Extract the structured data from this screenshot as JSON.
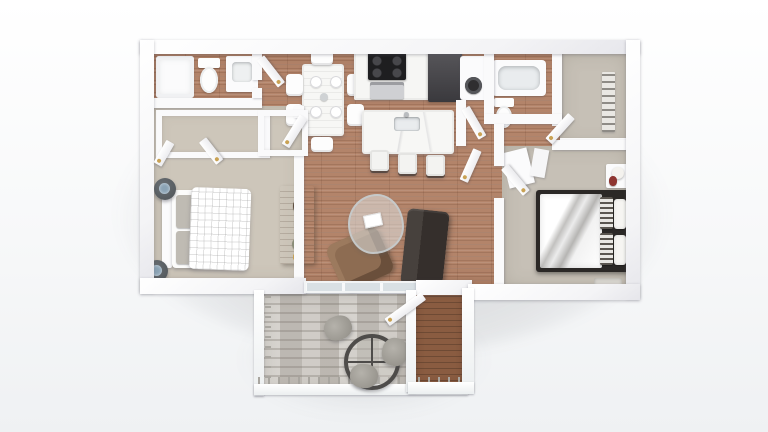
{
  "scene": {
    "title": "3D rendered apartment floor plan, top-down dollhouse view on white studio background",
    "units_of_text_visible": "none",
    "layout": "two-bedroom two-bath apartment with open kitchen/living area, rear balcony patio and side entry hall"
  },
  "colors": {
    "page_bg_top": "#ffffff",
    "page_bg_bottom": "#eff1f3",
    "wall_shade": "#e6e6eb",
    "wood_floor": "#b3846a",
    "carpet": "#cdc6ba",
    "carpet_2": "#c6c0b6",
    "patio_floor": "#c9c5bf",
    "entry_wood": "#8a5c41",
    "appliance_steel": "#cfd0d3",
    "fridge_dark": "#3a393d",
    "stove_black": "#1e1e20",
    "sofa_dark": "#352f2c",
    "armchair_brown": "#8d6c52",
    "console_wood": "#8f7a64",
    "bed_frame_dark": "#2b2826",
    "pillow_stripe": "#5a554f",
    "duvet_gray": "#c2c1bf",
    "gold_accent": "#c9a254",
    "glass_pane": "#d9e0e4",
    "lamp_red": "#8e3530",
    "lamp_blue": "#8ba3b5",
    "patio_chair": "#8f8c85",
    "table_ring_dark": "#4e4c4a",
    "shadow": "rgba(70,75,82,0.20)"
  },
  "rooms": {
    "bathroom_1": {
      "name": "Bathroom 1",
      "floor": "hardwood",
      "furniture": [
        "shower",
        "toilet",
        "vanity sink"
      ]
    },
    "bedroom_1": {
      "name": "Bedroom 1 with walk-in closet",
      "floor": "beige carpet",
      "furniture": [
        "white bed with quilted duvet",
        "gray pillows",
        "two round dark nightstands with blue lamps",
        "closet units with open doors"
      ]
    },
    "dining_area": {
      "name": "Dining area",
      "floor": "hardwood",
      "furniture": [
        "white dining table",
        "six white chairs",
        "four place settings",
        "two gold wall prints"
      ]
    },
    "kitchen": {
      "name": "Kitchen with laundry nook",
      "floor": "hardwood",
      "furniture": [
        "counter with black cooktop range and oven",
        "dark refrigerator",
        "front-load washer",
        "marble island with sink",
        "three bar stools"
      ]
    },
    "bathroom_2": {
      "name": "Bathroom 2",
      "floor": "hardwood",
      "furniture": [
        "bathtub",
        "toilet"
      ]
    },
    "closet_2": {
      "name": "Walk-in closet 2",
      "floor": "beige carpet",
      "furniture": [
        "slatted shelf rack",
        "open door"
      ]
    },
    "hallway": {
      "name": "Hallway",
      "floor": "hardwood",
      "furniture": [
        "several open white doors with gold hinges"
      ]
    },
    "living_room": {
      "name": "Living room",
      "floor": "hardwood",
      "furniture": [
        "wood media console with vases and plant",
        "brown armchair",
        "organic glass coffee table with white book",
        "dark gray sofa",
        "sliding glass door to patio"
      ]
    },
    "bedroom_2": {
      "name": "Bedroom 2",
      "floor": "gray-beige carpet",
      "furniture": [
        "dark-frame bed with white and gray duvet",
        "striped and white pillows",
        "nightstand with red lamp",
        "open wardrobe doors",
        "door mat"
      ]
    },
    "patio": {
      "name": "Balcony patio",
      "floor": "gray plank tile",
      "furniture": [
        "round glass bistro table with dark rim",
        "three gray wicker chairs",
        "white railing with balusters"
      ]
    },
    "entry": {
      "name": "Entry hall",
      "floor": "dark hardwood",
      "furniture": [
        "open front door with gold hinge"
      ]
    }
  }
}
